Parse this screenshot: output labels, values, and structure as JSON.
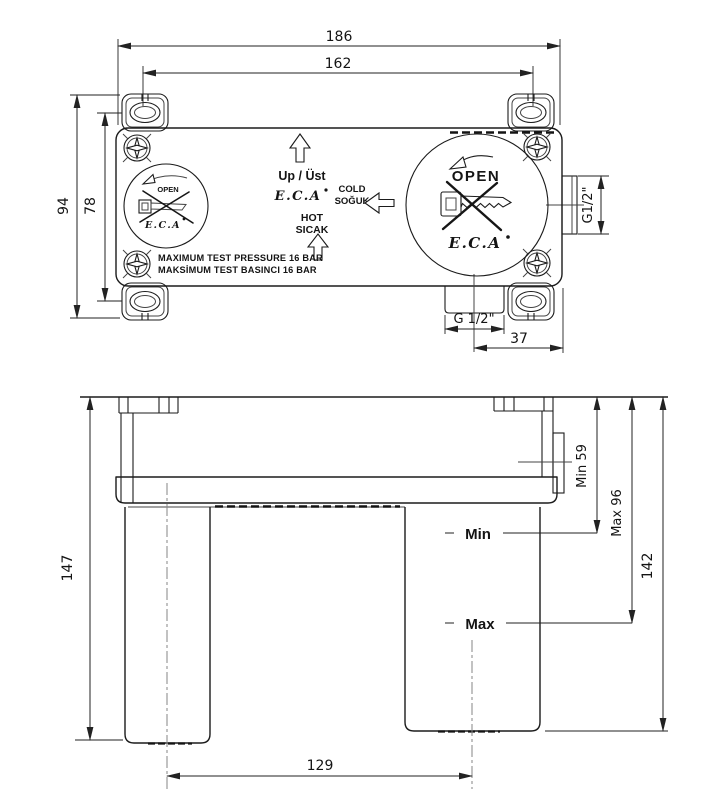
{
  "drawing": {
    "brand": "E.C.A",
    "top_view": {
      "labels": {
        "up": "Up / Üst",
        "cold_line1": "COLD",
        "cold_line2": "SOĞUK",
        "hot_line1": "HOT",
        "hot_line2": "SICAK",
        "open_left": "OPEN",
        "open_right": "OPEN",
        "pressure_line1": "MAXIMUM TEST PRESSURE 16 BAR",
        "pressure_line2": "MAKSİMUM TEST BASINCI 16 BAR"
      },
      "dimensions": {
        "overall_width": "186",
        "slot_spacing": "162",
        "overall_height": "94",
        "slot_height": "78",
        "bottom_outlet_thread": "G 1/2\"",
        "side_outlet_thread": "G1/2\"",
        "outlet_offset": "37"
      }
    },
    "front_view": {
      "labels": {
        "min": "Min",
        "max": "Max"
      },
      "dimensions": {
        "overall_height": "147",
        "min_depth": "Min 59",
        "max_depth": "Max 96",
        "body_height": "142",
        "leg_spacing": "129"
      }
    }
  }
}
